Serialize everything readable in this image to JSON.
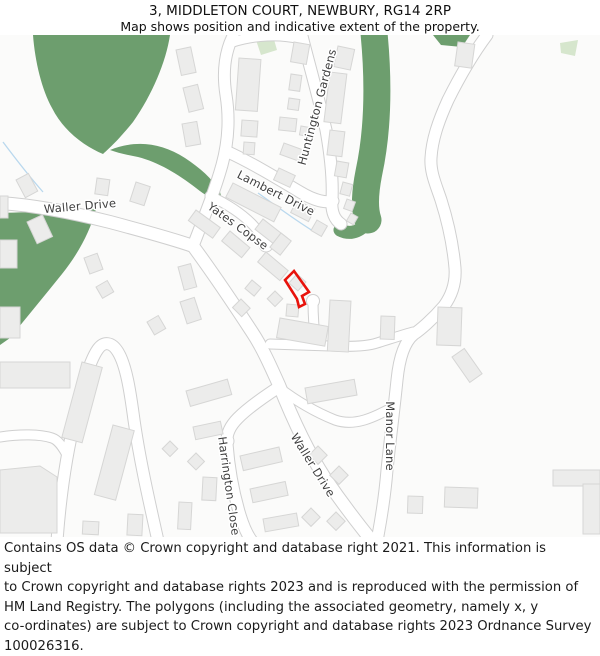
{
  "header": {
    "title": "3, MIDDLETON COURT, NEWBURY, RG14 2RP",
    "subtitle": "Map shows position and indicative extent of the property."
  },
  "footer": {
    "lines": [
      "Contains OS data © Crown copyright and database right 2021. This information is subject",
      "to Crown copyright and database rights 2023 and is reproduced with the permission of",
      "HM Land Registry. The polygons (including the associated geometry, namely x, y",
      "co-ordinates) are subject to Crown copyright and database rights 2023 Ordnance Survey",
      "100026316."
    ]
  },
  "map": {
    "colors": {
      "background": "#fbfbfa",
      "green": "#6d9e6e",
      "pale_green": "#d6e6cd",
      "road_fill": "#ffffff",
      "road_casing": "#cfcfcf",
      "building_fill": "#ececeb",
      "building_stroke": "#d6d6d5",
      "water": "#b9d8ee",
      "plot_red": "#e8130c",
      "label": "#3f3f3f"
    },
    "streets": [
      {
        "name": "Waller Drive",
        "x": 80,
        "y": 206,
        "rot": -5
      },
      {
        "name": "Lambert Drive",
        "x": 276,
        "y": 193,
        "rot": 27
      },
      {
        "name": "Yates Copse",
        "x": 238,
        "y": 226,
        "rot": 36
      },
      {
        "name": "Huntington Gardens",
        "x": 317,
        "y": 107,
        "rot": -75
      },
      {
        "name": "Waller Drive",
        "x": 313,
        "y": 465,
        "rot": 58
      },
      {
        "name": "Harrington Close",
        "x": 229,
        "y": 486,
        "rot": 82
      },
      {
        "name": "Manor Lane",
        "x": 390,
        "y": 436,
        "rot": 90
      }
    ],
    "greens": {
      "blobs": [
        "M33,35 L170,35 C166,62 152,95 133,122 C120,138 112,146 103,154 C86,147 64,132 52,108 C42,90 35,62 33,35 Z",
        "M110,150 C135,140 160,142 185,158 C200,168 212,178 220,192 L222,200 C215,201 206,196 196,188 C178,174 158,162 138,157 C128,155 118,153 110,150 Z",
        "M0,213 C35,212 70,211 96,209 C90,232 78,254 62,274 C46,294 26,318 10,338 L0,345 Z",
        "M433,35 L470,35 L462,47 L441,45 Z"
      ],
      "bands": [
        {
          "d": "M374,33 C379,85 378,130 369,172 C365,192 364,208 368,220",
          "w": 27
        },
        {
          "d": "M369,219 C363,230 352,236 340,230",
          "w": 13
        }
      ],
      "pale": [
        "256,40 273,36 277,50 261,55",
        "560,43 578,40 575,56 561,53"
      ]
    },
    "streams": [
      "M3,142 C15,158 28,175 43,192",
      "M258,193 C275,205 295,220 313,231"
    ],
    "roads": [
      {
        "d": "M0,203 C30,205 70,212 110,222 C140,230 170,238 193,246",
        "w": 12
      },
      {
        "d": "M193,246 C215,276 235,306 252,332 C262,347 270,365 279,385 C295,425 310,455 325,478 C340,500 355,520 372,541",
        "w": 12
      },
      {
        "d": "M193,246 C205,215 215,190 222,165 C228,143 230,120 226,95 C222,70 226,50 233,36",
        "w": 11
      },
      {
        "d": "M233,42 C255,35 280,34 300,39",
        "w": 9
      },
      {
        "d": "M302,36 C308,60 318,95 326,130 C331,158 333,180 332,200 C331,212 335,220 341,224",
        "w": 11
      },
      {
        "d": "M228,152 C250,162 275,177 300,192 C315,201 326,203 333,201",
        "w": 11
      },
      {
        "d": "M210,196 C225,203 240,212 252,224 C260,232 264,239 266,245",
        "w": 9
      },
      {
        "d": "M313,301 C313,315 314,330 316,344",
        "w": 9
      },
      {
        "d": "M270,344 L330,346 C352,347 368,346 377,343 C390,339 402,335 413,332",
        "w": 9
      },
      {
        "d": "M278,387 C295,400 315,412 335,420 C355,427 375,417 393,407",
        "w": 9
      },
      {
        "d": "M487,35 C472,55 458,80 448,100 C438,122 432,140 431,158 C430,172 436,185 441,200 C448,222 453,245 455,268 C456,282 452,295 444,306 C432,320 420,330 414,334 C404,342 399,360 397,380 C394,410 390,440 387,470 C385,495 381,520 377,541",
        "w": 11
      },
      {
        "d": "M279,387 C262,398 248,408 238,418 C230,426 226,434 227,444 C229,470 234,495 240,515 C244,528 248,536 252,541",
        "w": 11
      },
      {
        "d": "M0,437 C20,434 40,434 52,438 C58,440 62,446 66,453",
        "w": 9
      },
      {
        "d": "M57,541 C60,500 66,455 76,415 C82,388 90,360 98,349 C104,341 112,342 118,352 C126,365 130,390 134,420 C140,462 150,505 158,541",
        "w": 11
      }
    ],
    "bulbs": [
      [
        266,
        245,
        6.5
      ],
      [
        313,
        301,
        6
      ],
      [
        227,
        441,
        6.5
      ]
    ],
    "buildings": [
      [
        176,
        50,
        15,
        26,
        -12
      ],
      [
        183,
        88,
        15,
        25,
        -14
      ],
      [
        182,
        124,
        15,
        23,
        -10
      ],
      [
        239,
        58,
        22,
        52,
        4
      ],
      [
        242,
        120,
        16,
        16,
        4
      ],
      [
        244,
        142,
        11,
        12,
        4
      ],
      [
        294,
        42,
        16,
        20,
        10
      ],
      [
        291,
        74,
        11,
        16,
        8
      ],
      [
        289,
        98,
        11,
        11,
        8
      ],
      [
        280,
        117,
        17,
        13,
        6
      ],
      [
        284,
        143,
        24,
        12,
        20
      ],
      [
        279,
        168,
        18,
        13,
        25
      ],
      [
        301,
        126,
        9,
        9,
        10
      ],
      [
        338,
        46,
        17,
        21,
        12
      ],
      [
        330,
        72,
        17,
        50,
        7
      ],
      [
        330,
        130,
        15,
        25,
        7
      ],
      [
        337,
        161,
        12,
        15,
        10
      ],
      [
        343,
        182,
        10,
        12,
        15
      ],
      [
        347,
        199,
        9,
        10,
        20
      ],
      [
        351,
        213,
        8,
        9,
        30
      ],
      [
        458,
        42,
        17,
        24,
        8
      ],
      [
        233,
        183,
        54,
        16,
        27
      ],
      [
        297,
        200,
        20,
        14,
        27
      ],
      [
        317,
        220,
        12,
        12,
        30
      ],
      [
        196,
        210,
        30,
        13,
        36
      ],
      [
        230,
        231,
        26,
        13,
        40
      ],
      [
        263,
        219,
        30,
        13,
        38
      ],
      [
        281,
        233,
        13,
        18,
        38
      ],
      [
        266,
        252,
        29,
        13,
        40
      ],
      [
        297,
        274,
        12,
        12,
        42
      ],
      [
        275,
        291,
        11,
        11,
        45
      ],
      [
        252,
        280,
        12,
        11,
        40
      ],
      [
        241,
        299,
        13,
        12,
        45
      ],
      [
        287,
        304,
        12,
        12,
        5
      ],
      [
        178,
        267,
        13,
        24,
        -15
      ],
      [
        180,
        302,
        15,
        23,
        -18
      ],
      [
        147,
        322,
        13,
        15,
        -30
      ],
      [
        280,
        318,
        49,
        20,
        10
      ],
      [
        330,
        300,
        21,
        51,
        3
      ],
      [
        381,
        316,
        14,
        23,
        2
      ],
      [
        438,
        307,
        24,
        38,
        2
      ],
      [
        452,
        357,
        15,
        31,
        -35
      ],
      [
        318,
        446,
        13,
        13,
        45
      ],
      [
        339,
        466,
        13,
        13,
        45
      ],
      [
        311,
        508,
        13,
        13,
        45
      ],
      [
        336,
        512,
        13,
        13,
        45
      ],
      [
        305,
        388,
        50,
        16,
        -10
      ],
      [
        445,
        487,
        33,
        20,
        2
      ],
      [
        408,
        496,
        15,
        17,
        2
      ],
      [
        186,
        391,
        43,
        16,
        -16
      ],
      [
        193,
        427,
        28,
        13,
        -12
      ],
      [
        240,
        456,
        40,
        15,
        -13
      ],
      [
        250,
        489,
        36,
        14,
        -12
      ],
      [
        263,
        519,
        34,
        13,
        -10
      ],
      [
        203,
        477,
        14,
        23,
        3
      ],
      [
        179,
        502,
        13,
        27,
        3
      ],
      [
        196,
        453,
        12,
        12,
        45
      ],
      [
        170,
        441,
        11,
        11,
        45
      ],
      [
        128,
        514,
        15,
        21,
        3
      ],
      [
        83,
        521,
        16,
        13,
        3
      ],
      [
        82,
        362,
        21,
        78,
        15
      ],
      [
        113,
        425,
        22,
        72,
        15
      ],
      [
        0,
        362,
        70,
        26,
        0
      ],
      [
        0,
        240,
        17,
        28,
        0
      ],
      [
        0,
        307,
        20,
        31,
        0
      ],
      [
        16,
        180,
        14,
        20,
        -28
      ],
      [
        27,
        222,
        17,
        24,
        -25
      ],
      [
        97,
        178,
        13,
        16,
        8
      ],
      [
        136,
        182,
        15,
        20,
        18
      ],
      [
        84,
        258,
        14,
        17,
        -20
      ],
      [
        96,
        287,
        13,
        13,
        -30
      ],
      [
        0,
        196,
        8,
        22,
        0
      ],
      [
        553,
        470,
        47,
        16,
        0
      ],
      [
        583,
        484,
        17,
        50,
        0
      ]
    ],
    "building_polys": [
      "0,470 40,466 57,477 57,533 0,533"
    ],
    "property_outline": {
      "points": "294,271 285,280 297,299 299,307 305,304 302,296 309,292"
    }
  }
}
